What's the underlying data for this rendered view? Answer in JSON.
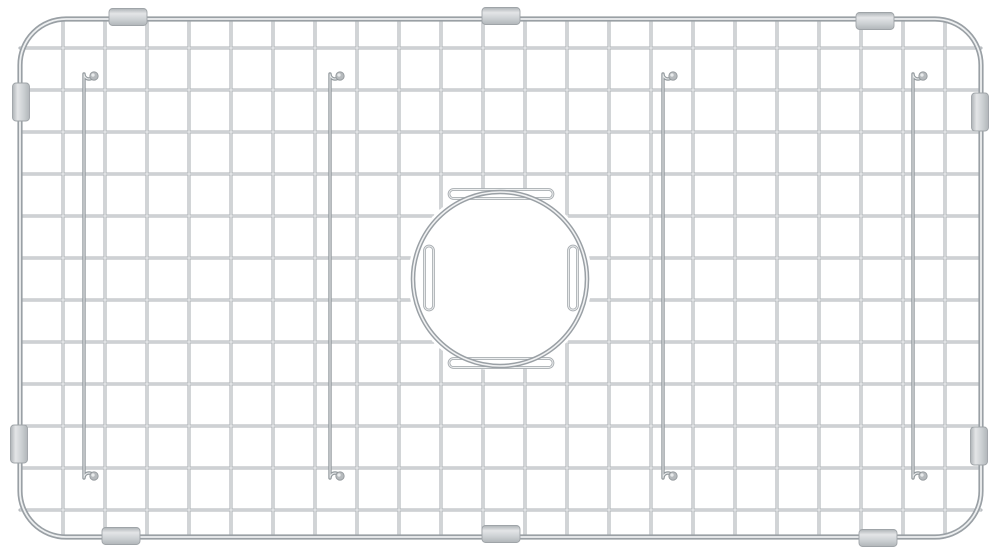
{
  "meta": {
    "subject": "stainless-steel-sink-bottom-grid",
    "background_color": "#ffffff"
  },
  "canvas": {
    "width": 1000,
    "height": 559
  },
  "frame": {
    "x": 20,
    "y": 19,
    "width": 961,
    "height": 518,
    "corner_radius": 46,
    "base_color": "#9aa0a5",
    "base_width": 5.2,
    "highlight_color": "#eef0f1",
    "highlight_width": 1.8
  },
  "grid": {
    "vertical_wires": {
      "count": 22,
      "x_start": 63,
      "x_end": 945,
      "y_top": 19,
      "y_bottom": 537
    },
    "horizontal_wires": {
      "count": 12,
      "y_start": 48,
      "y_end": 510,
      "x_left": 20,
      "x_right": 981
    },
    "base_color": "#adb2b6",
    "base_width": 3.1,
    "highlight_color": "#eef0f1",
    "highlight_width": 1.1
  },
  "drain_opening": {
    "cx": 500,
    "cy": 279,
    "radius": 87,
    "clear_radius": 92,
    "base_color": "#9aa0a5",
    "base_width": 4.6,
    "highlight_color": "#f1f2f3",
    "highlight_width": 1.6,
    "bend_capsules": [
      {
        "x": 449,
        "y": 189.5,
        "w": 104,
        "h": 9,
        "orient": "h"
      },
      {
        "x": 449,
        "y": 358.5,
        "w": 104,
        "h": 9,
        "orient": "h"
      },
      {
        "x": 424.5,
        "y": 246,
        "w": 9,
        "h": 64,
        "orient": "v"
      },
      {
        "x": 568.5,
        "y": 246,
        "w": 9,
        "h": 64,
        "orient": "v"
      }
    ],
    "bend_base_color": "#a8adb1",
    "bend_base_width": 2.7,
    "bend_highlight_color": "#eef0f1",
    "bend_highlight_width": 0.9
  },
  "feet_wires": {
    "x_positions": [
      84,
      330,
      663,
      913
    ],
    "y_top": 74,
    "y_bottom": 478,
    "hook_offset": 10,
    "hook_radius": 5,
    "ball_radius": 4.2,
    "base_color": "#939a9e",
    "base_width": 3.4,
    "highlight_color": "#e9ebec",
    "highlight_width": 1.0,
    "ball_fill": "#b6babd",
    "ball_edge": "#8f9498"
  },
  "bumpers": {
    "edge_color": "#9fa4a8",
    "gradient_stops": [
      "#aeb3b6",
      "#e3e5e7",
      "#ccd0d3",
      "#b1b6b9"
    ],
    "horizontal_size": {
      "w": 38,
      "h": 17,
      "rx": 3.5
    },
    "vertical_size": {
      "w": 17,
      "h": 38,
      "rx": 3.5
    },
    "horizontal_positions": [
      {
        "cx": 128,
        "cy": 17
      },
      {
        "cx": 501,
        "cy": 16
      },
      {
        "cx": 875,
        "cy": 21
      },
      {
        "cx": 121,
        "cy": 536
      },
      {
        "cx": 501,
        "cy": 534
      },
      {
        "cx": 878,
        "cy": 538
      }
    ],
    "vertical_positions": [
      {
        "cx": 21,
        "cy": 102
      },
      {
        "cx": 19,
        "cy": 444
      },
      {
        "cx": 980,
        "cy": 112
      },
      {
        "cx": 979,
        "cy": 446
      }
    ]
  }
}
